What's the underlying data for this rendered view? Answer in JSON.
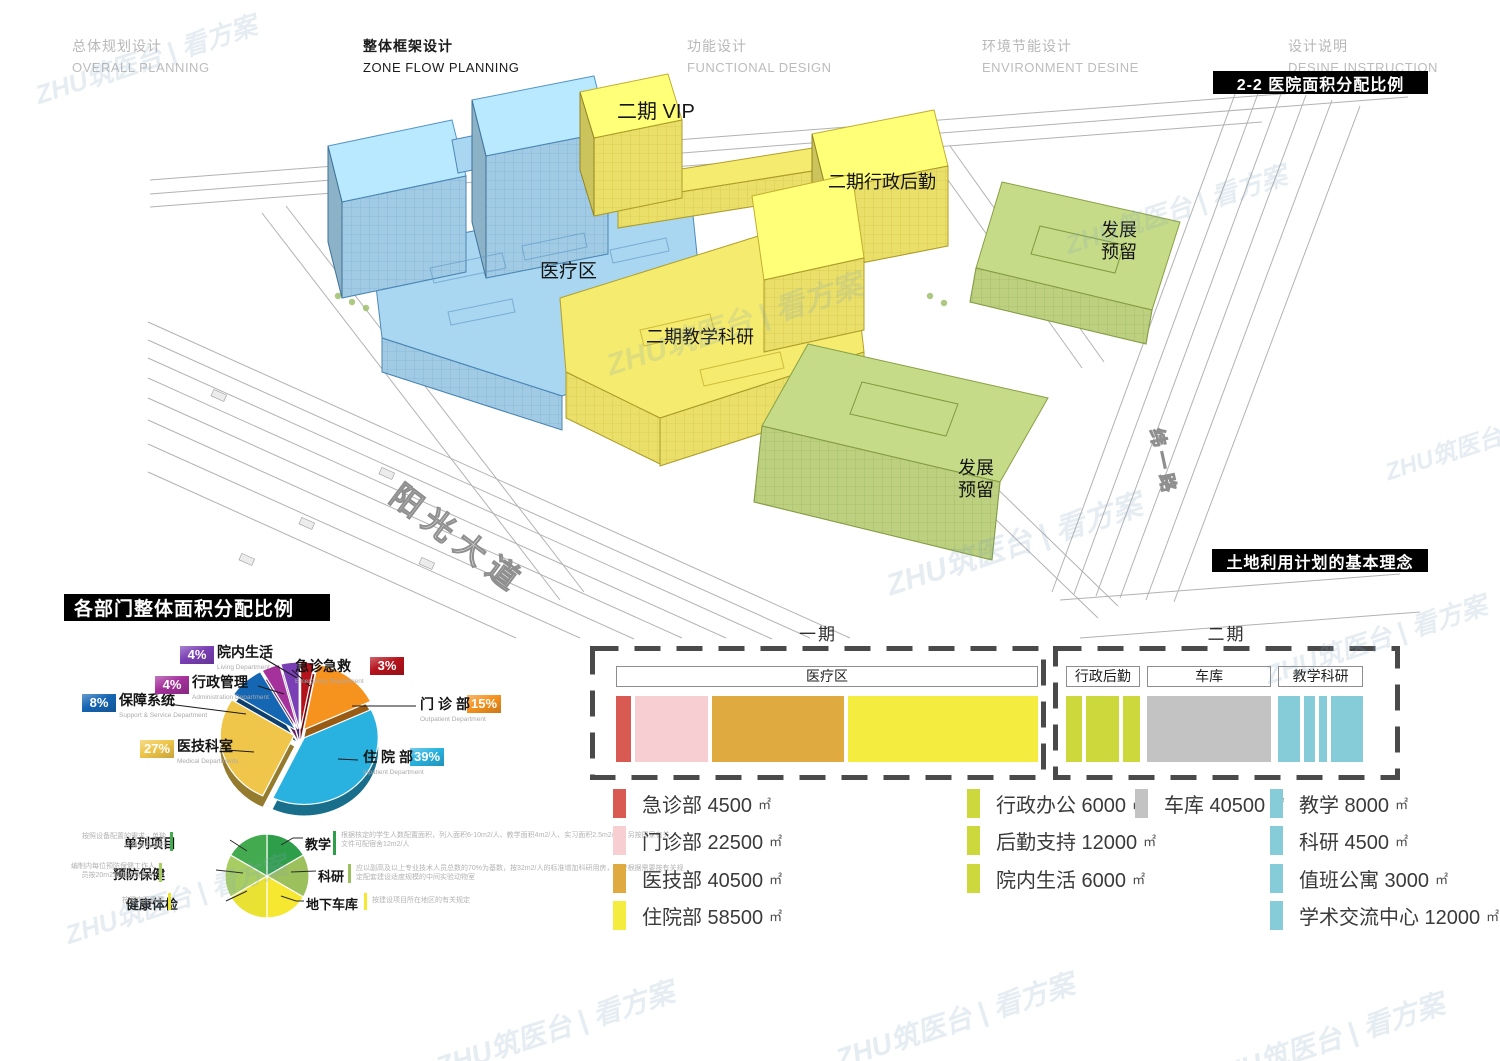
{
  "colors": {
    "phase1_blue": "#a9d6f0",
    "phase2_yellow": "#f5eb6e",
    "reserve_green": "#c6db87",
    "badge_bar_bg": "#000000"
  },
  "watermark": "ZHU筑医台 | 看方案",
  "nav": {
    "tabs": [
      {
        "cn": "总体规划设计",
        "en": "OVERALL PLANNING",
        "active": false
      },
      {
        "cn": "整体框架设计",
        "en": "ZONE FLOW PLANNING",
        "active": true
      },
      {
        "cn": "功能设计",
        "en": "FUNCTIONAL DESIGN",
        "active": false
      },
      {
        "cn": "环境节能设计",
        "en": "ENVIRONMENT DESINE",
        "active": false
      },
      {
        "cn": "设计说明",
        "en": "DESINE INSTRUCTION",
        "active": false
      }
    ]
  },
  "badges": {
    "section_top_right": "2-2 医院面积分配比例",
    "land_use": "土地利用计划的基本理念",
    "pie_section": "各部门整体面积分配比例"
  },
  "site_plan": {
    "zone_labels": [
      {
        "text": "二期 VIP",
        "x": 617,
        "y": 118,
        "size": 20,
        "lines": 1
      },
      {
        "text": "二期行政后勤",
        "x": 828,
        "y": 188,
        "size": 18,
        "lines": 1
      },
      {
        "text": "医疗区",
        "x": 540,
        "y": 277,
        "size": 19,
        "lines": 1
      },
      {
        "text": "二期教学科研",
        "x": 646,
        "y": 343,
        "size": 18,
        "lines": 1
      },
      {
        "text": "发展预留",
        "x": 1101,
        "y": 236,
        "size": 18,
        "lines": 2
      },
      {
        "text": "发展预留",
        "x": 958,
        "y": 474,
        "size": 18,
        "lines": 2
      }
    ],
    "road_labels": [
      {
        "text": "阳光大道",
        "x": 388,
        "y": 500,
        "size": 31,
        "rotate": 37,
        "spacing": 9
      },
      {
        "text": "纬一路",
        "x": 1150,
        "y": 430,
        "size": 18,
        "rotate": 78,
        "spacing": 5
      }
    ]
  },
  "chart_data": [
    {
      "id": "dept_area_pie",
      "type": "pie",
      "title": "各部门整体面积分配比例",
      "legend_position": "around",
      "slices": [
        {
          "label": "急诊急救",
          "en": "Emergency Department",
          "pct": 3,
          "color": "#b5121b"
        },
        {
          "label": "门诊部",
          "en": "Outpatient Department",
          "pct": 15,
          "color": "#f6921e"
        },
        {
          "label": "住院部",
          "en": "Inpatient Department",
          "pct": 39,
          "color": "#29b2e0"
        },
        {
          "label": "医技科室",
          "en": "Medical Departments",
          "pct": 27,
          "color": "#f0c64a"
        },
        {
          "label": "保障系统",
          "en": "Support & Service Department",
          "pct": 8,
          "color": "#1566b3"
        },
        {
          "label": "行政管理",
          "en": "Administration Department",
          "pct": 4,
          "color": "#a4319c"
        },
        {
          "label": "院内生活",
          "en": "Living Department",
          "pct": 4,
          "color": "#7a3fb5"
        }
      ]
    },
    {
      "id": "single_items_pie",
      "type": "pie",
      "slices": [
        {
          "label": "教学",
          "value": 1,
          "color": "#2f9e4a",
          "note": "根据核定的学生人数配置面积，列入面积6-10m2/人、教学面积4m2/人、实习面积2.5m2/人，另按国家有关文件可配宿舍12m2/人"
        },
        {
          "label": "科研",
          "value": 1,
          "color": "#9cc05c",
          "note": "应以副高及以上专业技术人员总数的70%为基数，按32m2/人的标准增加科研用房，并应根据需要按有关规定配套建设适度规模的中间实验动物室"
        },
        {
          "label": "地下车库",
          "value": 1,
          "color": "#f6e831",
          "note": "按建设项目所在地区的有关规定"
        },
        {
          "label": "健康体检",
          "value": 1,
          "color": "#e9e233",
          "note": "按照实际需要"
        },
        {
          "label": "预防保健",
          "value": 1,
          "color": "#a8cd63",
          "note": "编制内每位预防保健工作人员按20m2增加建筑面积"
        },
        {
          "label": "单列项目",
          "value": 1,
          "color": "#44aa4f",
          "note": "按照设备配置的需求，单独计算房间面积"
        }
      ]
    },
    {
      "id": "area_strip",
      "type": "bar",
      "unit": "㎡",
      "phases": [
        {
          "name": "一期",
          "groups": [
            {
              "header": "医疗区",
              "items": [
                {
                  "label": "急诊部",
                  "value": 4500,
                  "color": "#d95a52"
                },
                {
                  "label": "门诊部",
                  "value": 22500,
                  "color": "#f7ced2"
                },
                {
                  "label": "医技部",
                  "value": 40500,
                  "color": "#dfab40"
                },
                {
                  "label": "住院部",
                  "value": 58500,
                  "color": "#f4ec3f"
                }
              ]
            }
          ]
        },
        {
          "name": "二期",
          "groups": [
            {
              "header": "行政后勤",
              "items": [
                {
                  "label": "行政办公",
                  "value": 6000,
                  "color": "#ccd83c"
                },
                {
                  "label": "后勤支持",
                  "value": 12000,
                  "color": "#ccd83c"
                },
                {
                  "label": "院内生活",
                  "value": 6000,
                  "color": "#ccd83c"
                }
              ]
            },
            {
              "header": "车库",
              "items": [
                {
                  "label": "车库",
                  "value": 40500,
                  "color": "#c3c3c3"
                }
              ]
            },
            {
              "header": "教学科研",
              "items": [
                {
                  "label": "教学",
                  "value": 8000,
                  "color": "#85cbd8"
                },
                {
                  "label": "科研",
                  "value": 4500,
                  "color": "#85cbd8"
                },
                {
                  "label": "值班公寓",
                  "value": 3000,
                  "color": "#85cbd8"
                },
                {
                  "label": "学术交流中心",
                  "value": 12000,
                  "color": "#85cbd8"
                }
              ]
            }
          ]
        }
      ]
    }
  ]
}
